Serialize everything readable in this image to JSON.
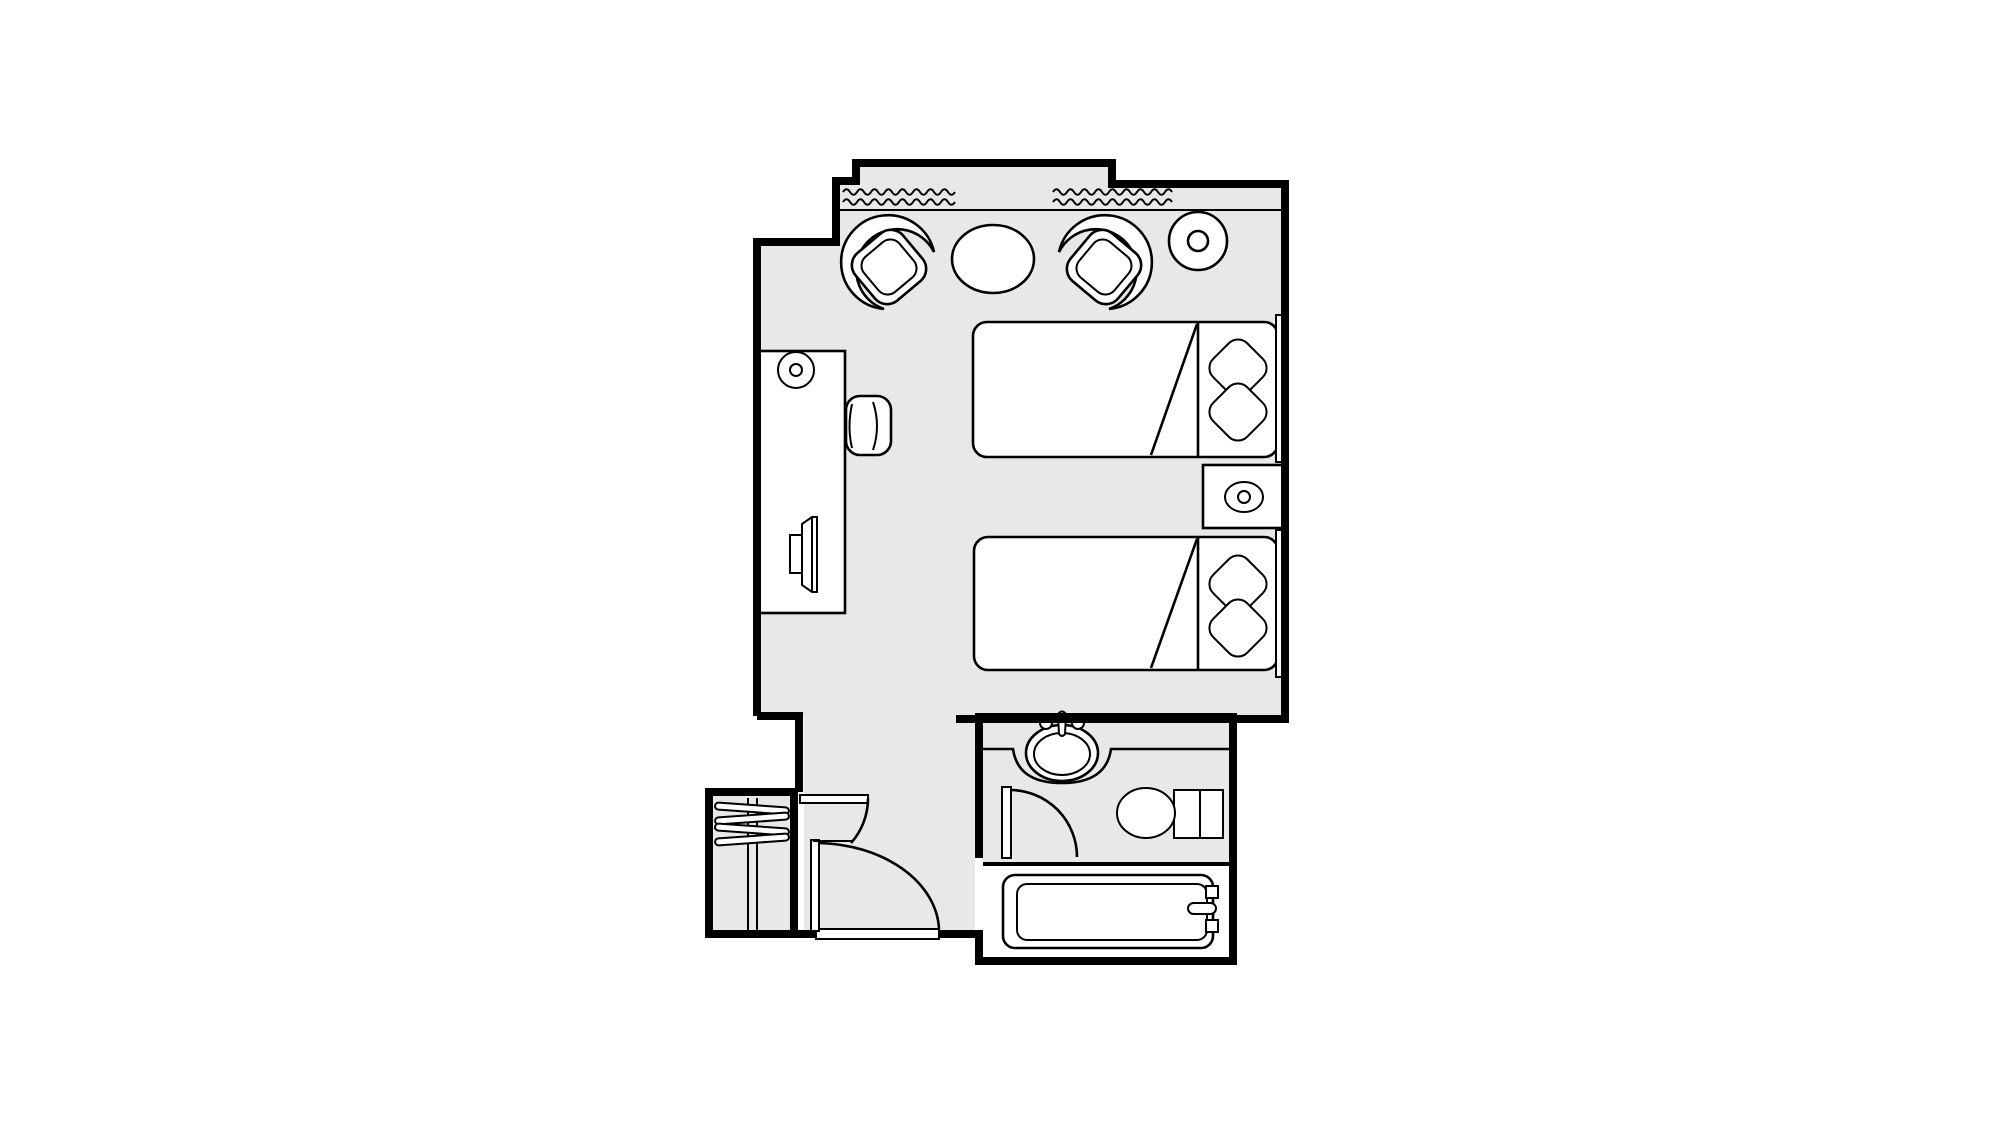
{
  "document": {
    "kind": "hotel-room-floor-plan",
    "visible_text": [],
    "colors": {
      "paper": "#ffffff",
      "floor_fill": "#e8e8e8",
      "line_ink": "#000000",
      "furniture_fill": "#ffffff"
    },
    "rooms": [
      {
        "name": "bedroom",
        "floor": "gray"
      },
      {
        "name": "entry-corridor",
        "floor": "gray"
      },
      {
        "name": "closet",
        "floor": "gray"
      },
      {
        "name": "bathroom-sink-area",
        "floor": "gray"
      },
      {
        "name": "bathroom-tub-area",
        "floor": "white"
      }
    ],
    "architecture": [
      {
        "name": "window-band",
        "symbol": "two double rows of wavy lines along top wall"
      },
      {
        "name": "top-wall-notch",
        "symbol": "raised center section of top exterior wall"
      },
      {
        "name": "entry-door",
        "symbol": "quarter-circle swing arc with leaf"
      },
      {
        "name": "inner-vestibule-door",
        "symbol": "small swing arc with leaf"
      },
      {
        "name": "bathroom-door",
        "symbol": "small swing arc with leaf"
      },
      {
        "name": "entry-threshold",
        "symbol": "white sill bar in bottom wall opening"
      }
    ],
    "furniture": [
      {
        "name": "armchair-left",
        "count": 1
      },
      {
        "name": "round-table",
        "count": 1
      },
      {
        "name": "armchair-right",
        "count": 1
      },
      {
        "name": "floor-lamp-top-right",
        "count": 1
      },
      {
        "name": "desk",
        "count": 1
      },
      {
        "name": "desk-lamp",
        "count": 1
      },
      {
        "name": "tv-on-desk",
        "count": 1
      },
      {
        "name": "desk-chair",
        "count": 1
      },
      {
        "name": "bed",
        "count": 2,
        "details": "each with 2 diamond pillows, headboard bar and folded-sheet diagonal"
      },
      {
        "name": "nightstand-with-lamp",
        "count": 1
      },
      {
        "name": "closet-hangers",
        "count": 4
      },
      {
        "name": "sink-in-counter",
        "count": 1
      },
      {
        "name": "toilet",
        "count": 1
      },
      {
        "name": "bathtub-with-faucet",
        "count": 1
      }
    ]
  }
}
